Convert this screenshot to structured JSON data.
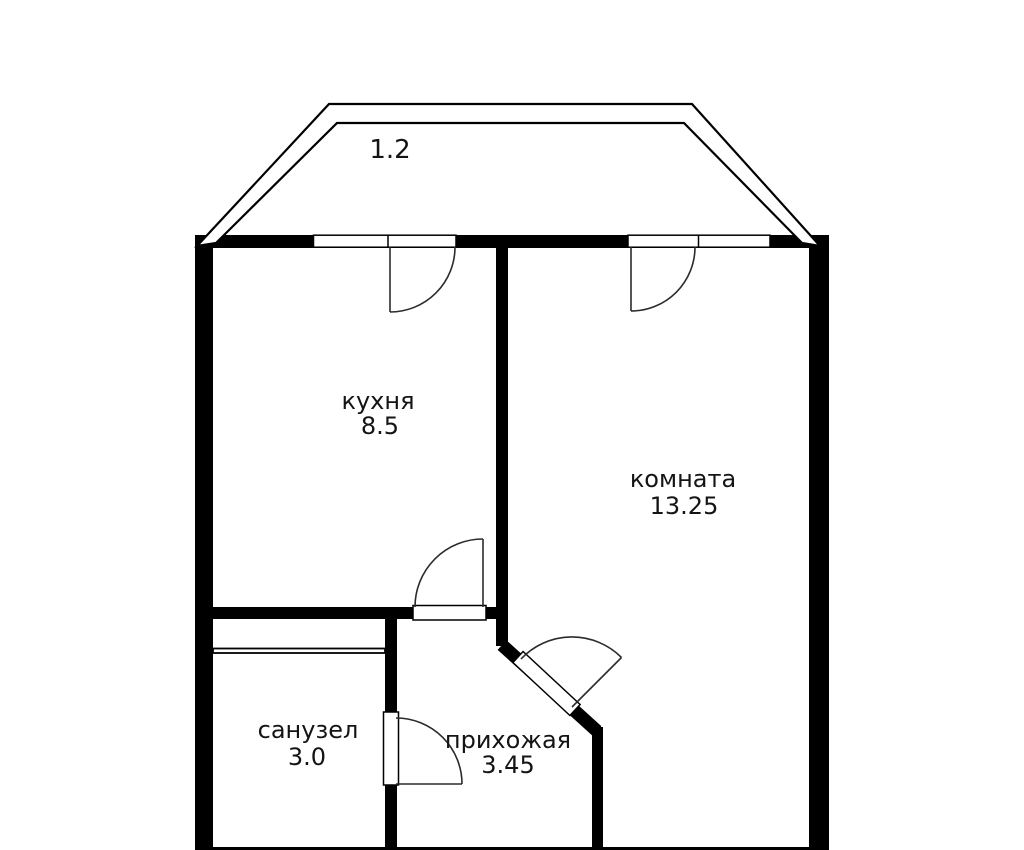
{
  "plan": {
    "type": "apartment-floor-plan",
    "background_color": "#ffffff",
    "wall_color": "#000000",
    "swing_line_color": "#2b2b2b",
    "text_color": "#141414",
    "balcony": {
      "area": "1.2"
    },
    "rooms": [
      {
        "id": "kitchen",
        "name": "кухня",
        "area": "8.5"
      },
      {
        "id": "room",
        "name": "комната",
        "area": "13.25"
      },
      {
        "id": "bathroom",
        "name": "санузел",
        "area": "3.0"
      },
      {
        "id": "hallway",
        "name": "прихожая",
        "area": "3.45"
      }
    ]
  }
}
